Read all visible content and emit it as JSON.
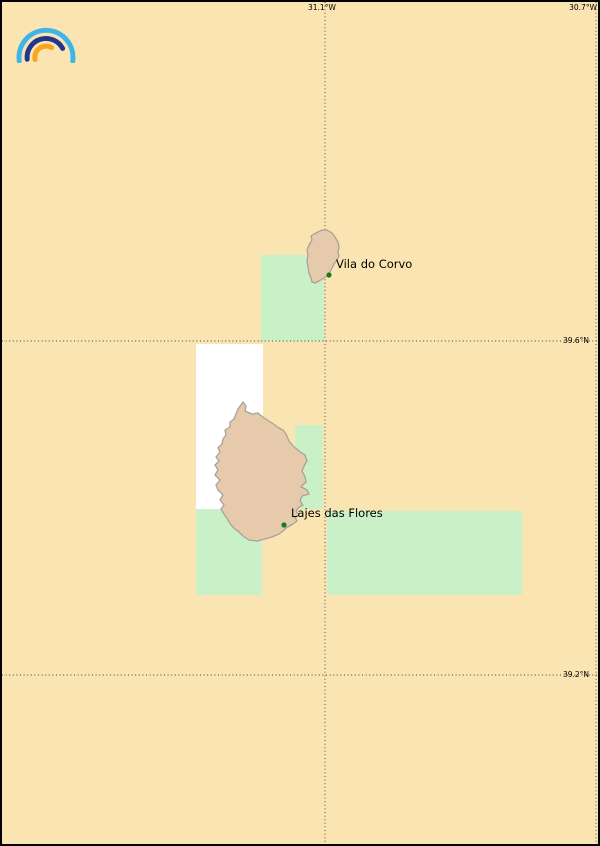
{
  "map": {
    "type": "coastal-coverage-map",
    "logo": {
      "name": "rainbow-arcs-logo"
    },
    "grid": {
      "meridians": [
        {
          "label": "31.1°W",
          "x": 323
        },
        {
          "label": "30.7°W",
          "x": 594
        }
      ],
      "parallels": [
        {
          "label": "39.6°N",
          "y": 339
        },
        {
          "label": "39.2°N",
          "y": 673
        }
      ]
    },
    "places": [
      {
        "name": "Vila do Corvo",
        "marker": "green-dot"
      },
      {
        "name": "Lajes das Flores",
        "marker": "green-dot"
      }
    ],
    "islands": [
      {
        "name": "Corvo"
      },
      {
        "name": "Flores"
      }
    ],
    "colors": {
      "background_sea": "#fae5b2",
      "coverage_green": "#c9f0c7",
      "coverage_white": "#ffffff",
      "island_fill": "#e7caab",
      "island_stroke": "#a8a29b",
      "grid_line": "#3f3f3f",
      "marker_green": "#1a7a1f",
      "label_text": "#000000",
      "logo_light_blue": "#3db5e9",
      "logo_navy": "#20368f",
      "logo_orange": "#f5a623",
      "border": "#000000"
    }
  }
}
